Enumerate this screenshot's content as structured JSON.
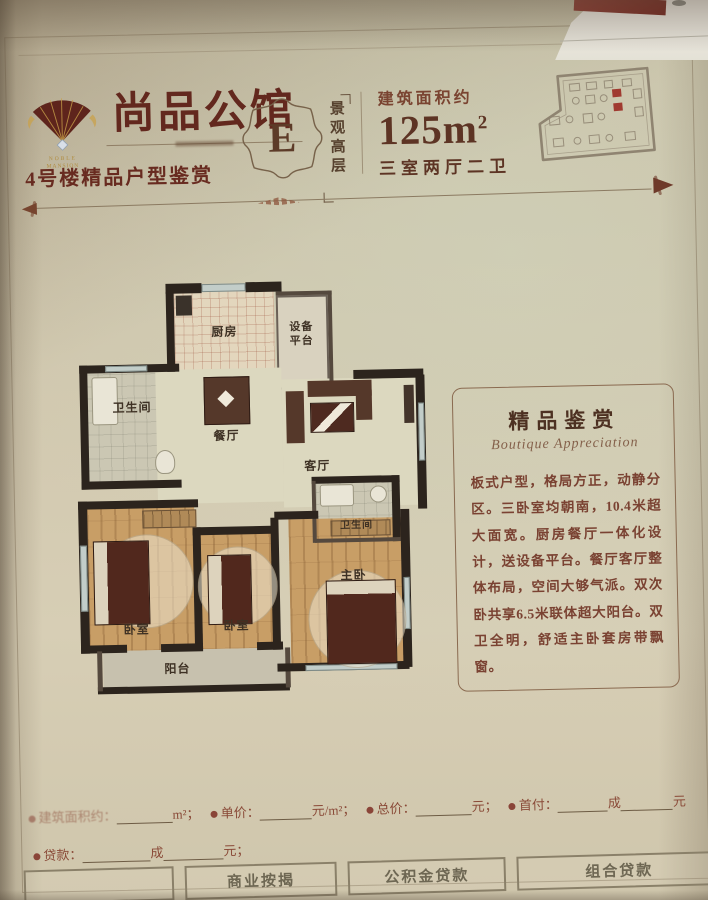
{
  "header": {
    "brand_cn": "尚品公馆",
    "brand_en_1": "NOBLE",
    "brand_en_2": "MANSION",
    "subtitle": "4号楼精品户型鉴赏",
    "unit_letter": "E",
    "unit_tag": "景观高层",
    "area_label": "建筑面积约",
    "area_value": "125m",
    "area_sup": "2",
    "rooms_spec": "三室两厅二卫"
  },
  "floorplan": {
    "rooms": {
      "kitchen": "厨房",
      "equipment": "设备平台",
      "bath1": "卫生间",
      "dining": "餐厅",
      "living": "客厅",
      "bath2": "卫生间",
      "bedroom1": "卧室",
      "bedroom2": "卧室",
      "master": "主卧",
      "balcony": "阳台"
    }
  },
  "panel": {
    "title": "精品鉴赏",
    "subtitle": "Boutique Appreciation",
    "body": "板式户型，格局方正，动静分区。三卧室均朝南，10.4米超大面宽。厨房餐厅一体化设计，送设备平台。餐厅客厅整体布局，空间大够气派。双次卧共享6.5米联体超大阳台。双卫全明，舒适主卧套房带飘窗。"
  },
  "form": {
    "area_label": "建筑面积约：",
    "area_unit": "m²；",
    "price_label": "单价：",
    "price_unit": "元/m²；",
    "total_label": "总价：",
    "total_unit": "元；",
    "down_label": "首付：",
    "down_mid": "成",
    "down_tail": "元",
    "loan_label": "贷款：",
    "loan_mid": "成",
    "loan_unit": "元；"
  },
  "table": {
    "cells": [
      "",
      "商业按揭",
      "公积金贷款",
      "组合贷款"
    ]
  },
  "colors": {
    "maroon": "#63281e",
    "brown": "#5d3424",
    "paper": "#cdc4ac",
    "wall": "#2c241d",
    "highlight_red": "#a03a30"
  }
}
